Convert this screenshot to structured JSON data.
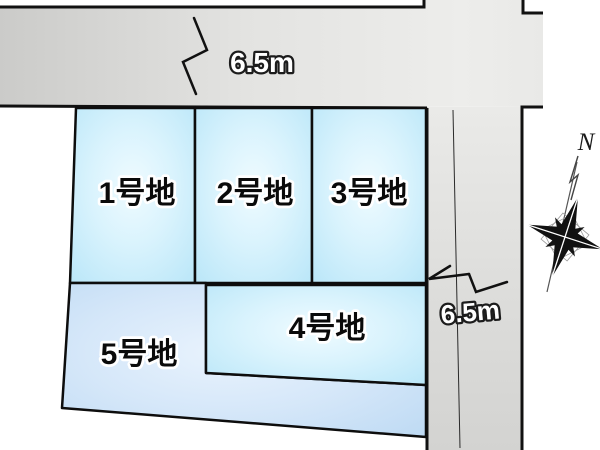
{
  "plots": [
    {
      "label": "1号地"
    },
    {
      "label": "2号地"
    },
    {
      "label": "3号地"
    },
    {
      "label": "4号地"
    },
    {
      "label": "5号地"
    }
  ],
  "dimensions": {
    "top_road_width": "6.5m",
    "right_road_width": "6.5m"
  },
  "compass": {
    "north": "N"
  },
  "colors": {
    "background": "#ffffff",
    "road_gray_dark": "#c6c6c4",
    "road_gray_light": "#ededeb",
    "plot_cyan_edge": "#b9e6f8",
    "plot_cyan_center": "#effbff",
    "plot_blue_edge": "#bcd9f3",
    "plot_blue_center": "#e9f3fd",
    "outline": "#111111"
  }
}
